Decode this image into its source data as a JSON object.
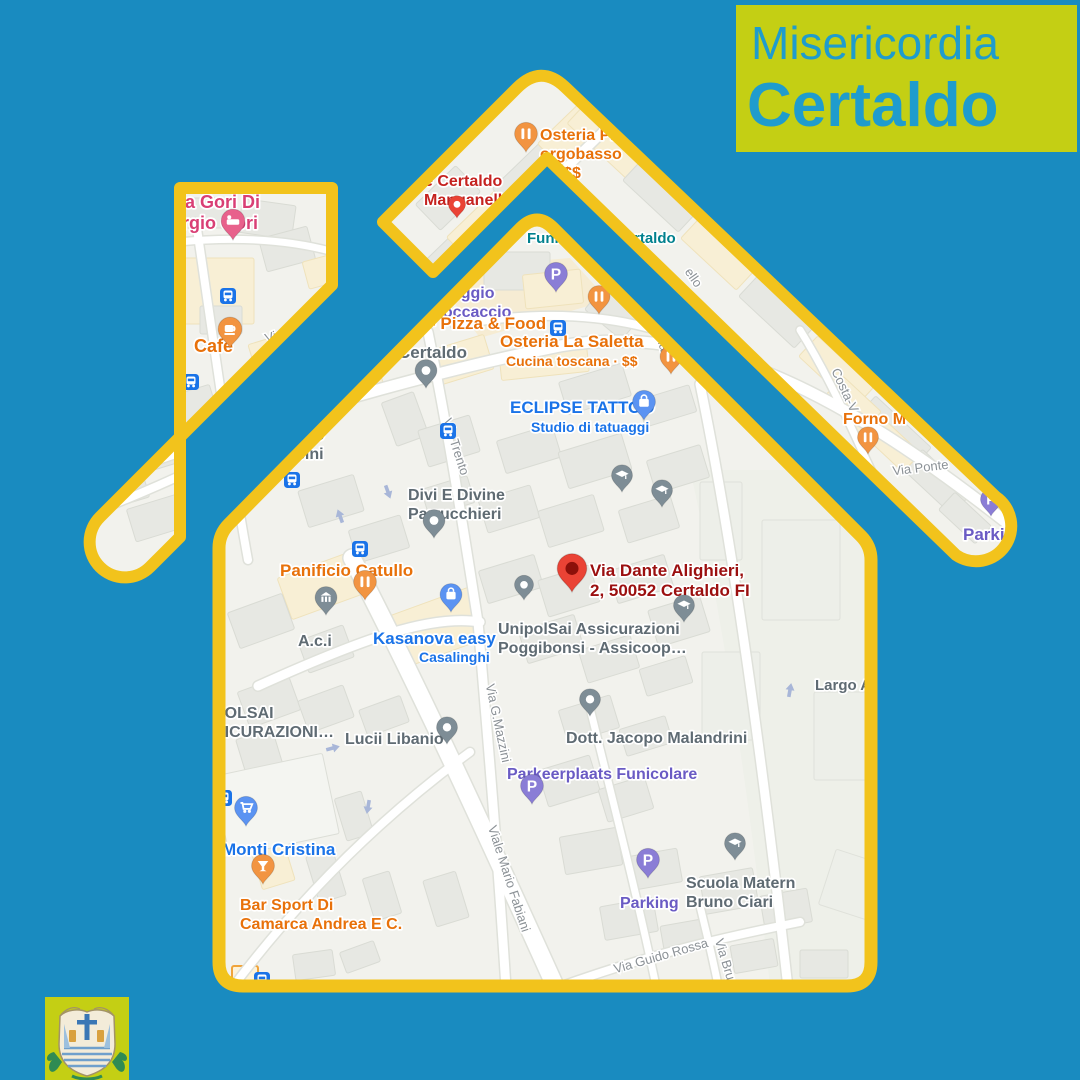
{
  "banner": {
    "line1": "Misericordia",
    "line2": "Certaldo"
  },
  "colors": {
    "background": "#198bc0",
    "banner_bg": "#c4cf14",
    "banner_text": "#1f9ccd",
    "outline_yellow": "#f2c31c",
    "map_land": "#f2f2ed",
    "poi_orange": "#e8710a",
    "poi_pink": "#d93f75",
    "poi_red": "#c5221f",
    "poi_darkred": "#9b0f0f",
    "poi_blue": "#1a73e8",
    "poi_purple": "#6a5bc4",
    "poi_teal": "#01818e",
    "poi_gray": "#5f6b73",
    "street_gray": "#8b9196",
    "marker_pink": "#e8618c",
    "marker_orange": "#f29441",
    "marker_gray": "#7e8d96",
    "marker_blue": "#5b93f2",
    "marker_purple": "#8a7dd6",
    "marker_red": "#ea4335",
    "transit_blue": "#1a73e8",
    "arrow_blue": "#a8b6d8"
  },
  "map": {
    "parking_glyph": "P",
    "streets": [
      {
        "label": "Via Il Giugno",
        "x": 302,
        "y": 332,
        "rot": -17
      },
      {
        "label": "Via Trento",
        "x": 452,
        "y": 448,
        "rot": 72
      },
      {
        "label": "Via G.Mazzini",
        "x": 494,
        "y": 724,
        "rot": 78
      },
      {
        "label": "Viale Mario Fabiani",
        "x": 505,
        "y": 880,
        "rot": 72
      },
      {
        "label": "Via Guido Rossa",
        "x": 662,
        "y": 960,
        "rot": -16
      },
      {
        "label": "Via Brun",
        "x": 722,
        "y": 964,
        "rot": 73
      },
      {
        "label": "Via Ponte",
        "x": 921,
        "y": 472,
        "rot": -7
      },
      {
        "label": "Costa-V",
        "x": 841,
        "y": 392,
        "rot": 65
      },
      {
        "label": "ello",
        "x": 690,
        "y": 280,
        "rot": 55
      },
      {
        "label": "Via",
        "x": 658,
        "y": 343,
        "rot": 72
      }
    ],
    "pois": [
      {
        "name": "casa-gori",
        "color": "poi_pink",
        "x": 152,
        "y": 208,
        "size": 18,
        "lines": [
          "Casa Gori Di",
          "Giorgio Gori"
        ]
      },
      {
        "name": "cafe",
        "color": "poi_orange",
        "x": 194,
        "y": 352,
        "size": 18,
        "lines": [
          "Cafè"
        ]
      },
      {
        "name": "certaldo-manganelli",
        "color": "poi_red",
        "x": 424,
        "y": 186,
        "size": 16,
        "lines": [
          "e Certaldo",
          "Manganell"
        ]
      },
      {
        "name": "osteria-borgobasso",
        "color": "poi_orange",
        "x": 540,
        "y": 140,
        "size": 16,
        "lines": [
          "Osteria Pi",
          "orgobasso",
          "a · $$"
        ]
      },
      {
        "name": "funicolare",
        "color": "poi_teal",
        "x": 527,
        "y": 243,
        "size": 15,
        "lines": [
          "Funic"
        ]
      },
      {
        "name": "funicolare-certaldo",
        "color": "poi_teal",
        "x": 634,
        "y": 243,
        "size": 15,
        "lines": [
          "rtaldo"
        ]
      },
      {
        "name": "parcheggio-boccaccio",
        "color": "poi_purple",
        "x": 418,
        "y": 298,
        "size": 16,
        "lines": [
          "archeggio",
          "a Boccaccio"
        ]
      },
      {
        "name": "pizza-food",
        "color": "poi_orange",
        "x": 430,
        "y": 329,
        "size": 17,
        "lines": [
          "- Pizza & Food"
        ]
      },
      {
        "name": "osteria-saletta",
        "color": "poi_orange",
        "x": 500,
        "y": 347,
        "size": 17,
        "lines": [
          "Osteria La Saletta"
        ]
      },
      {
        "name": "saletta-sub",
        "color": "poi_orange",
        "x": 506,
        "y": 366,
        "size": 14,
        "lines": [
          "Cucina toscana · $$"
        ]
      },
      {
        "name": "eclipse-tattoo",
        "color": "poi_blue",
        "x": 510,
        "y": 413,
        "size": 17,
        "lines": [
          "ECLIPSE TATTOO"
        ]
      },
      {
        "name": "eclipse-sub",
        "color": "poi_blue",
        "x": 531,
        "y": 432,
        "size": 14,
        "lines": [
          "Studio di tatuaggi"
        ]
      },
      {
        "name": "certaldo-pin",
        "color": "poi_gray",
        "x": 398,
        "y": 358,
        "size": 17,
        "lines": [
          "Certaldo"
        ]
      },
      {
        "name": "divi-divine",
        "color": "poi_gray",
        "x": 408,
        "y": 500,
        "size": 16,
        "lines": [
          "Divi E Divine",
          "Parrucchieri"
        ]
      },
      {
        "name": "ulio-sini",
        "color": "poi_gray",
        "x": 296,
        "y": 440,
        "size": 16,
        "lines": [
          "ulio",
          "sini"
        ]
      },
      {
        "name": "chieri",
        "color": "poi_gray",
        "x": 88,
        "y": 486,
        "size": 15,
        "lines": [
          "chieri"
        ]
      },
      {
        "name": "panificio-catullo",
        "color": "poi_orange",
        "x": 280,
        "y": 576,
        "size": 17,
        "lines": [
          "Panificio Catullo"
        ]
      },
      {
        "name": "aci",
        "color": "poi_gray",
        "x": 298,
        "y": 646,
        "size": 16,
        "lines": [
          "A.c.i"
        ]
      },
      {
        "name": "kasanova",
        "color": "poi_blue",
        "x": 373,
        "y": 644,
        "size": 17,
        "lines": [
          "Kasanova easy"
        ]
      },
      {
        "name": "kasanova-sub",
        "color": "poi_blue",
        "x": 419,
        "y": 662,
        "size": 14,
        "lines": [
          "Casalinghi"
        ]
      },
      {
        "name": "dante-address",
        "color": "poi_darkred",
        "x": 590,
        "y": 576,
        "size": 17,
        "lines": [
          "Via Dante Alighieri,",
          "2, 50052 Certaldo FI"
        ]
      },
      {
        "name": "unipolsai",
        "color": "poi_gray",
        "x": 498,
        "y": 634,
        "size": 16,
        "lines": [
          "UnipolSai Assicurazioni",
          "Poggibonsi -  Assicoop…"
        ]
      },
      {
        "name": "polsai",
        "color": "poi_gray",
        "x": 214,
        "y": 718,
        "size": 16,
        "lines": [
          "POLSAI",
          "SICURAZIONI…"
        ]
      },
      {
        "name": "lucii-libanio",
        "color": "poi_gray",
        "x": 345,
        "y": 744,
        "size": 16,
        "lines": [
          "Lucii Libanio"
        ]
      },
      {
        "name": "malandrini",
        "color": "poi_gray",
        "x": 566,
        "y": 743,
        "size": 16,
        "lines": [
          "Dott. Jacopo Malandrini"
        ]
      },
      {
        "name": "parkeerplaats",
        "color": "poi_purple",
        "x": 507,
        "y": 779,
        "size": 16,
        "lines": [
          "Parkeerplaats Funicolare"
        ]
      },
      {
        "name": "monti-cristina",
        "color": "poi_blue",
        "x": 222,
        "y": 855,
        "size": 17,
        "lines": [
          "Monti Cristina"
        ]
      },
      {
        "name": "bar-sport",
        "color": "poi_orange",
        "x": 240,
        "y": 910,
        "size": 16,
        "lines": [
          "Bar Sport Di",
          "Camarca Andrea E C."
        ]
      },
      {
        "name": "parking",
        "color": "poi_purple",
        "x": 620,
        "y": 908,
        "size": 16,
        "lines": [
          "Parking"
        ]
      },
      {
        "name": "scuola-materna",
        "color": "poi_gray",
        "x": 686,
        "y": 888,
        "size": 16,
        "lines": [
          "Scuola Matern",
          "Bruno Ciari"
        ]
      },
      {
        "name": "largo",
        "color": "poi_gray",
        "x": 815,
        "y": 690,
        "size": 15,
        "lines": [
          "Largo A"
        ]
      },
      {
        "name": "forno",
        "color": "poi_orange",
        "x": 843,
        "y": 424,
        "size": 16,
        "lines": [
          "Forno M"
        ]
      },
      {
        "name": "parki",
        "color": "poi_purple",
        "x": 963,
        "y": 540,
        "size": 17,
        "lines": [
          "Parki"
        ]
      }
    ],
    "markers": [
      {
        "t": "pin",
        "g": "bed",
        "c": "marker_pink",
        "x": 233,
        "y": 240,
        "s": 1.25
      },
      {
        "t": "pin",
        "g": "cup",
        "c": "marker_orange",
        "x": 230,
        "y": 348,
        "s": 1.25
      },
      {
        "t": "pin",
        "g": "fork",
        "c": "marker_orange",
        "x": 357,
        "y": 261,
        "s": 1.15
      },
      {
        "t": "pin",
        "g": "fork",
        "c": "marker_orange",
        "x": 391,
        "y": 291,
        "s": 1.05
      },
      {
        "t": "pin",
        "g": "dot",
        "c": "marker_red",
        "x": 457,
        "y": 218,
        "s": 0.9
      },
      {
        "t": "pin",
        "g": "fork",
        "c": "marker_orange",
        "x": 526,
        "y": 152,
        "s": 1.2
      },
      {
        "t": "pin",
        "g": "fork",
        "c": "marker_orange",
        "x": 599,
        "y": 314,
        "s": 1.15
      },
      {
        "t": "pin",
        "g": "fork",
        "c": "marker_orange",
        "x": 671,
        "y": 374,
        "s": 1.15
      },
      {
        "t": "pin",
        "g": "P",
        "c": "marker_purple",
        "x": 556,
        "y": 292,
        "s": 1.2
      },
      {
        "t": "bus",
        "x": 558,
        "y": 328
      },
      {
        "t": "pin",
        "g": "dot",
        "c": "marker_gray",
        "x": 426,
        "y": 388,
        "s": 1.15
      },
      {
        "t": "pin",
        "g": "bag",
        "c": "marker_blue",
        "x": 644,
        "y": 420,
        "s": 1.2
      },
      {
        "t": "pin",
        "g": "dot",
        "c": "marker_gray",
        "x": 434,
        "y": 538,
        "s": 1.15
      },
      {
        "t": "pin",
        "g": "fork",
        "c": "marker_orange",
        "x": 365,
        "y": 600,
        "s": 1.2
      },
      {
        "t": "pin",
        "g": "bank",
        "c": "marker_gray",
        "x": 326,
        "y": 615,
        "s": 1.15
      },
      {
        "t": "pin",
        "g": "bag",
        "c": "marker_blue",
        "x": 451,
        "y": 612,
        "s": 1.15
      },
      {
        "t": "pin",
        "g": "dest",
        "c": "marker_red",
        "x": 572,
        "y": 592,
        "s": 1.55
      },
      {
        "t": "pin",
        "g": "dot",
        "c": "marker_gray",
        "x": 524,
        "y": 600,
        "s": 1.0
      },
      {
        "t": "pin",
        "g": "cap",
        "c": "marker_gray",
        "x": 622,
        "y": 492,
        "s": 1.1
      },
      {
        "t": "pin",
        "g": "cap",
        "c": "marker_gray",
        "x": 662,
        "y": 507,
        "s": 1.1
      },
      {
        "t": "pin",
        "g": "cap",
        "c": "marker_gray",
        "x": 684,
        "y": 622,
        "s": 1.1
      },
      {
        "t": "pin",
        "g": "dot",
        "c": "marker_gray",
        "x": 590,
        "y": 716,
        "s": 1.1
      },
      {
        "t": "pin",
        "g": "P",
        "c": "marker_purple",
        "x": 532,
        "y": 804,
        "s": 1.2
      },
      {
        "t": "pin",
        "g": "P",
        "c": "marker_purple",
        "x": 648,
        "y": 878,
        "s": 1.2
      },
      {
        "t": "pin",
        "g": "cart",
        "c": "marker_blue",
        "x": 246,
        "y": 826,
        "s": 1.2
      },
      {
        "t": "pin",
        "g": "bar",
        "c": "marker_orange",
        "x": 263,
        "y": 884,
        "s": 1.2
      },
      {
        "t": "pin",
        "g": "dot",
        "c": "marker_gray",
        "x": 447,
        "y": 744,
        "s": 1.1
      },
      {
        "t": "pin",
        "g": "cap",
        "c": "marker_gray",
        "x": 735,
        "y": 860,
        "s": 1.1
      },
      {
        "t": "pin",
        "g": "fork",
        "c": "marker_orange",
        "x": 868,
        "y": 454,
        "s": 1.1
      },
      {
        "t": "pin",
        "g": "P",
        "c": "marker_purple",
        "x": 991,
        "y": 516,
        "s": 1.1
      },
      {
        "t": "bus",
        "x": 228,
        "y": 296
      },
      {
        "t": "bus",
        "x": 191,
        "y": 382
      },
      {
        "t": "bus",
        "x": 292,
        "y": 480
      },
      {
        "t": "bus",
        "x": 360,
        "y": 549
      },
      {
        "t": "bus",
        "x": 224,
        "y": 798
      },
      {
        "t": "bus",
        "x": 448,
        "y": 431
      },
      {
        "t": "bus",
        "x": 262,
        "y": 980
      },
      {
        "t": "arrow",
        "x": 340,
        "y": 516,
        "r": -20
      },
      {
        "t": "arrow",
        "x": 388,
        "y": 492,
        "r": 160
      },
      {
        "t": "arrow",
        "x": 333,
        "y": 748,
        "r": 75
      },
      {
        "t": "arrow",
        "x": 368,
        "y": 807,
        "r": 190
      },
      {
        "t": "arrow",
        "x": 790,
        "y": 690,
        "r": 10
      }
    ]
  }
}
